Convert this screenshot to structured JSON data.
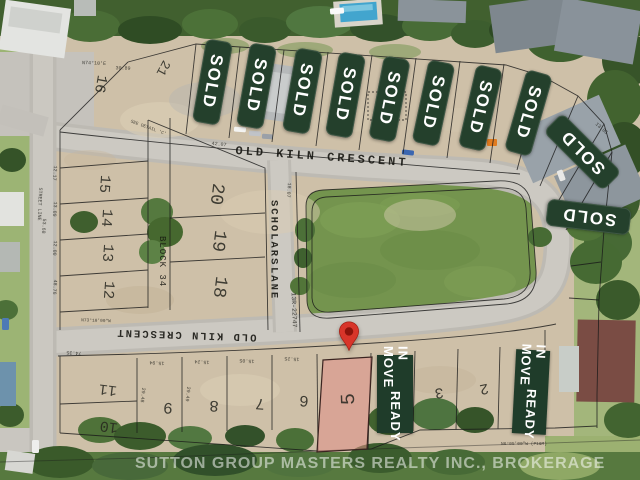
{
  "overlay": {
    "sold_label": "SOLD",
    "move_in_line1": "MOVE IN",
    "move_in_line2": "READY"
  },
  "streets": {
    "old_kiln_top": "OLD KILN CRESCENT",
    "old_kiln_bottom": "OLD KILN CRESCENT",
    "scholars_line1": "SCHOLARS",
    "scholars_line2": "LANE",
    "street_line": "STREET LINE",
    "block": "BLOCK 34",
    "plan_ref": "13R-22747"
  },
  "lots": [
    {
      "n": "16"
    },
    {
      "n": "21"
    },
    {
      "n": "15"
    },
    {
      "n": "14"
    },
    {
      "n": "13"
    },
    {
      "n": "12"
    },
    {
      "n": "20"
    },
    {
      "n": "19"
    },
    {
      "n": "18"
    },
    {
      "n": "11"
    },
    {
      "n": "10"
    },
    {
      "n": "9"
    },
    {
      "n": "8"
    },
    {
      "n": "7"
    },
    {
      "n": "6"
    },
    {
      "n": "5"
    },
    {
      "n": "3"
    },
    {
      "n": "2"
    }
  ],
  "survey": [
    {
      "t": "N74°10'E"
    },
    {
      "t": "30.89"
    },
    {
      "t": "15.94"
    },
    {
      "t": "15.48"
    },
    {
      "t": "15.24"
    },
    {
      "t": "42.07"
    },
    {
      "t": "12.17"
    },
    {
      "t": "13.09"
    },
    {
      "t": "53.68"
    },
    {
      "t": "12.00"
    },
    {
      "t": "48.76"
    },
    {
      "t": "18.07"
    },
    {
      "t": "74.35"
    },
    {
      "t": "15.94"
    },
    {
      "t": "15.24"
    },
    {
      "t": "15.05"
    },
    {
      "t": "15.25"
    },
    {
      "t": "29.48"
    },
    {
      "t": "29.49"
    },
    {
      "t": "N73°10'00\"W"
    },
    {
      "t": "N6°05'00\"W (P1&M)"
    },
    {
      "t": "SEE DETAIL 'C'"
    },
    {
      "t": "65.04"
    },
    {
      "t": "13.05"
    }
  ],
  "watermark": "SUTTON GROUP MASTERS REALTY INC., BROKERAGE",
  "colors": {
    "banner_green": "#24402c",
    "pin_red": "#d8352a",
    "lot5_pink": "#e08e86",
    "park_green": "#74944e"
  }
}
